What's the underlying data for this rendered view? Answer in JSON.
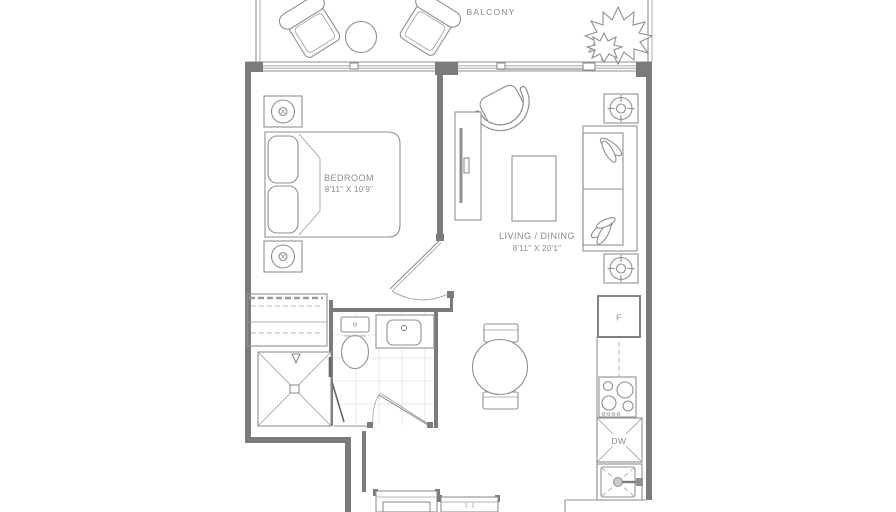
{
  "plan": {
    "balcony": {
      "label": "BALCONY"
    },
    "bedroom": {
      "name": "BEDROOM",
      "dimensions": "8'11\" X 10'9\""
    },
    "living_dining": {
      "name": "LIVING / DINING",
      "dimensions": "8'11\" X 20'1\""
    },
    "kitchen": {
      "fridge_label": "F",
      "dishwasher_label": "DW"
    },
    "colors": {
      "line": "#8f8f8f",
      "wall": "#7b7b7b",
      "text": "#8a8a8a",
      "tile": "#e2e2e2",
      "background": "#ffffff"
    }
  }
}
